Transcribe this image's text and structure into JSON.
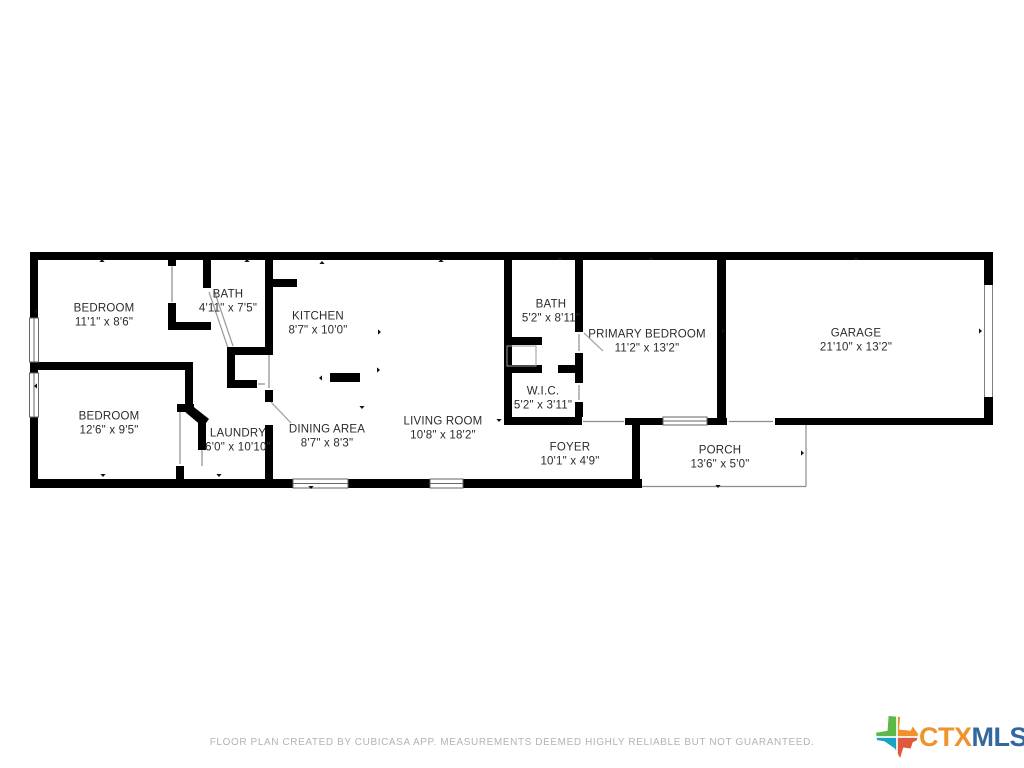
{
  "rooms": [
    {
      "id": "bedroom-1",
      "name": "BEDROOM",
      "dims": "11'1\" x 8'6\""
    },
    {
      "id": "bath-1",
      "name": "BATH",
      "dims": "4'11\" x 7'5\""
    },
    {
      "id": "kitchen",
      "name": "KITCHEN",
      "dims": "8'7\" x 10'0\""
    },
    {
      "id": "bath-2",
      "name": "BATH",
      "dims": "5'2\" x 8'11\""
    },
    {
      "id": "primary-bedroom",
      "name": "PRIMARY BEDROOM",
      "dims": "11'2\" x 13'2\""
    },
    {
      "id": "garage",
      "name": "GARAGE",
      "dims": "21'10\" x 13'2\""
    },
    {
      "id": "bedroom-2",
      "name": "BEDROOM",
      "dims": "12'6\" x 9'5\""
    },
    {
      "id": "laundry",
      "name": "LAUNDRY",
      "dims": "6'0\" x 10'10\""
    },
    {
      "id": "dining-area",
      "name": "DINING AREA",
      "dims": "8'7\" x 8'3\""
    },
    {
      "id": "living-room",
      "name": "LIVING ROOM",
      "dims": "10'8\" x 18'2\""
    },
    {
      "id": "wic",
      "name": "W.I.C.",
      "dims": "5'2\" x 3'11\""
    },
    {
      "id": "foyer",
      "name": "FOYER",
      "dims": "10'1\" x 4'9\""
    },
    {
      "id": "porch",
      "name": "PORCH",
      "dims": "13'6\" x 5'0\""
    }
  ],
  "footer": {
    "disclaimer": "FLOOR PLAN CREATED BY CUBICASA APP. MEASUREMENTS DEEMED HIGHLY RELIABLE BUT NOT GUARANTEED."
  },
  "logo": {
    "ctx": "CTX",
    "mls": "MLS"
  },
  "colors": {
    "wall": "#000000",
    "label_text": "#2b2b2b",
    "footer_text": "#b3b3b3",
    "ctx_orange": "#F0932C",
    "mls_blue": "#33689E",
    "texas_green": "#5CB947",
    "texas_orange": "#F0912D",
    "texas_teal": "#1BA3C6",
    "texas_red": "#E0593C"
  }
}
